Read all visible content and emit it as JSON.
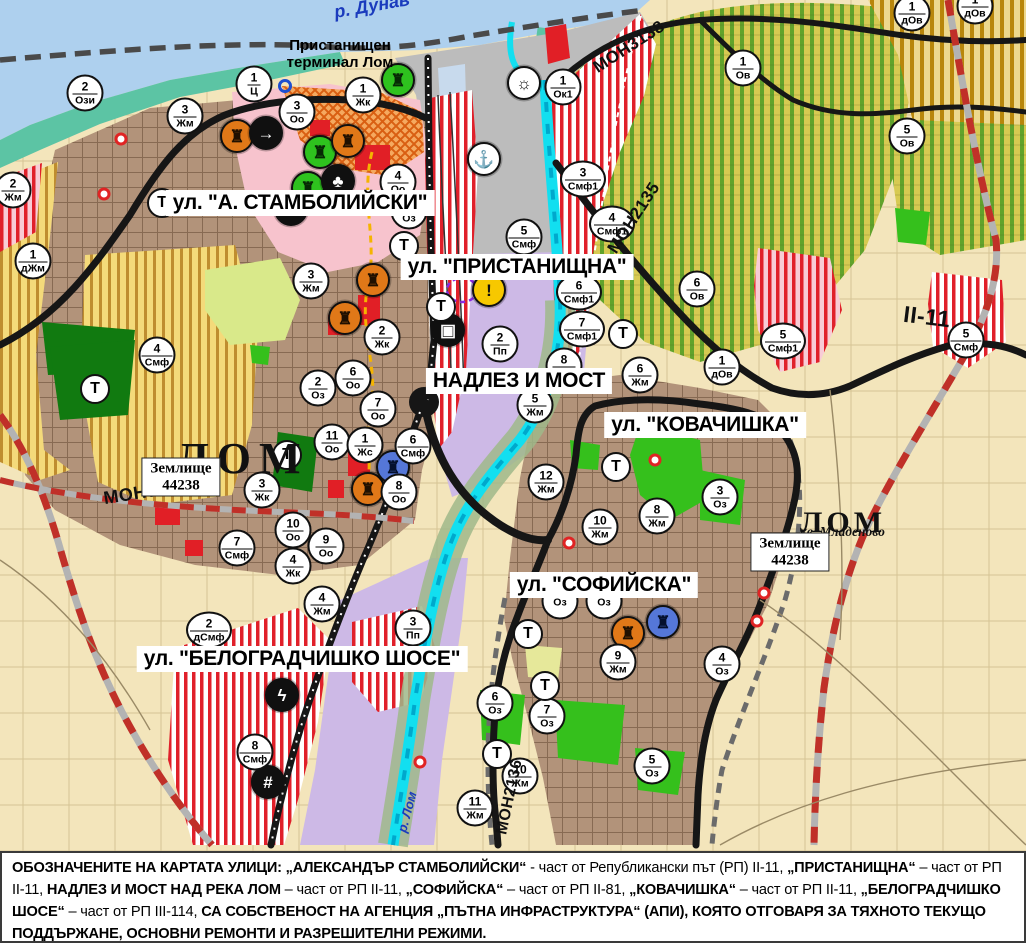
{
  "colors": {
    "field_beige": "#f3e5bb",
    "danube_blue": "#aed0ee",
    "shore_teal": "#5cc4a4",
    "port_gray": "#bcbcbc",
    "urban_brown": "#b2937a",
    "center_pink": "#f7c3cd",
    "industry_lavender": "#cdb9e6",
    "vineyard_green_stripe": "#61a32b",
    "vineyard_bg": "#d7ca52",
    "ochre_stripe": "#b8860b",
    "smf_red_stripe": "#e0202a",
    "park_green": "#35c01c",
    "forest_green": "#117a10",
    "road_black": "#161616",
    "road_red_dash": "#c03028",
    "river_cyan": "#12dff0",
    "label_blue": "#1b3bbd",
    "accent_red": "#e11f26",
    "warning_yellow": "#f7c800",
    "monument_orange": "#e07818",
    "monument_green": "#2ec21e",
    "monument_blue": "#5577d8"
  },
  "map": {
    "street_labels": [
      {
        "text": "ул. \"А. СТАМБОЛИЙСКИ\"",
        "x": 300,
        "y": 203
      },
      {
        "text": "ул. \"ПРИСТАНИЩНА\"",
        "x": 517,
        "y": 267
      },
      {
        "text": "НАДЛЕЗ И МОСТ",
        "x": 519,
        "y": 381
      },
      {
        "text": "ул. \"КОВАЧИШКА\"",
        "x": 705,
        "y": 425
      },
      {
        "text": "ул. \"СОФИЙСКА\"",
        "x": 604,
        "y": 585
      },
      {
        "text": "ул. \"БЕЛОГРАДЧИШКО ШОСЕ\"",
        "x": 302,
        "y": 659
      }
    ],
    "road_labels": [
      {
        "text": "МОН3139",
        "x": 146,
        "y": 492,
        "rot": -9,
        "fs": 18
      },
      {
        "text": "МОН2135",
        "x": 634,
        "y": 218,
        "rot": -57,
        "fs": 17
      },
      {
        "text": "МОН3138",
        "x": 629,
        "y": 47,
        "rot": -33,
        "fs": 17
      },
      {
        "text": "МОН2136",
        "x": 510,
        "y": 797,
        "rot": -78,
        "fs": 16
      },
      {
        "text": "II-11",
        "x": 927,
        "y": 317,
        "rot": 7,
        "fs": 23
      }
    ],
    "place_labels": [
      {
        "cls": "pl-river",
        "text": "р. Дунав",
        "x": 372,
        "y": 6,
        "rot": -10,
        "fs": 18
      },
      {
        "cls": "pl-terminal",
        "text": "Пристанищен\nтерминал Лом",
        "x": 340,
        "y": 54
      },
      {
        "cls": "pl-city",
        "text": "ЛОМ",
        "x": 176,
        "y": 433,
        "fs": 44,
        "ls": 8
      },
      {
        "cls": "pl-parcel",
        "text": "Землище\n44238",
        "x": 181,
        "y": 477
      },
      {
        "cls": "pl-city",
        "text": "ЛОМ",
        "x": 800,
        "y": 506,
        "fs": 30,
        "ls": 4
      },
      {
        "cls": "pl-subcity",
        "text": "кв. Младеново",
        "x": 800,
        "y": 524
      },
      {
        "cls": "pl-parcel",
        "text": "Землище\n44238",
        "x": 790,
        "y": 552
      },
      {
        "cls": "pl-river",
        "text": "р. Лом",
        "x": 407,
        "y": 812,
        "rot": -75,
        "fs": 13
      }
    ],
    "zone_markers": [
      {
        "x": 85,
        "y": 93,
        "num": "2",
        "code": "Ози"
      },
      {
        "x": 254,
        "y": 84,
        "num": "1",
        "code": "Ц"
      },
      {
        "x": 297,
        "y": 112,
        "num": "3",
        "code": "Оо"
      },
      {
        "x": 363,
        "y": 95,
        "num": "1",
        "code": "Жк"
      },
      {
        "x": 563,
        "y": 87,
        "num": "1",
        "code": "Ок1"
      },
      {
        "x": 185,
        "y": 116,
        "num": "3",
        "code": "Жм"
      },
      {
        "x": 13,
        "y": 190,
        "num": "2",
        "code": "Жм"
      },
      {
        "x": 33,
        "y": 261,
        "num": "1",
        "code": "дЖм"
      },
      {
        "x": 398,
        "y": 182,
        "num": "4",
        "code": "Оо"
      },
      {
        "x": 409,
        "y": 211,
        "num": "1",
        "code": "Оз"
      },
      {
        "x": 311,
        "y": 281,
        "num": "3",
        "code": "Жм"
      },
      {
        "x": 524,
        "y": 237,
        "num": "5",
        "code": "Смф"
      },
      {
        "x": 583,
        "y": 179,
        "num": "3",
        "code": "Смф1"
      },
      {
        "x": 612,
        "y": 224,
        "num": "4",
        "code": "Смф1"
      },
      {
        "x": 579,
        "y": 292,
        "num": "6",
        "code": "Смф1"
      },
      {
        "x": 582,
        "y": 329,
        "num": "7",
        "code": "Смф1"
      },
      {
        "x": 500,
        "y": 344,
        "num": "2",
        "code": "Пп"
      },
      {
        "x": 564,
        "y": 366,
        "num": "8",
        "code": "Жм"
      },
      {
        "x": 535,
        "y": 405,
        "num": "5",
        "code": "Жм"
      },
      {
        "x": 640,
        "y": 375,
        "num": "6",
        "code": "Жм"
      },
      {
        "x": 697,
        "y": 289,
        "num": "6",
        "code": "Ов"
      },
      {
        "x": 743,
        "y": 68,
        "num": "1",
        "code": "Ов"
      },
      {
        "x": 912,
        "y": 13,
        "num": "1",
        "code": "дОв"
      },
      {
        "x": 975,
        "y": 6,
        "num": "1",
        "code": "дОв"
      },
      {
        "x": 907,
        "y": 136,
        "num": "5",
        "code": "Ов"
      },
      {
        "x": 783,
        "y": 341,
        "num": "5",
        "code": "Смф1"
      },
      {
        "x": 722,
        "y": 367,
        "num": "1",
        "code": "дОв"
      },
      {
        "x": 966,
        "y": 340,
        "num": "5",
        "code": "Смф"
      },
      {
        "x": 382,
        "y": 337,
        "num": "2",
        "code": "Жк"
      },
      {
        "x": 353,
        "y": 378,
        "num": "6",
        "code": "Оо"
      },
      {
        "x": 318,
        "y": 388,
        "num": "2",
        "code": "Оз"
      },
      {
        "x": 378,
        "y": 409,
        "num": "7",
        "code": "Оо"
      },
      {
        "x": 332,
        "y": 442,
        "num": "11",
        "code": "Оо"
      },
      {
        "x": 365,
        "y": 445,
        "num": "1",
        "code": "Жс"
      },
      {
        "x": 413,
        "y": 446,
        "num": "6",
        "code": "Смф"
      },
      {
        "x": 399,
        "y": 492,
        "num": "8",
        "code": "Оо"
      },
      {
        "x": 293,
        "y": 530,
        "num": "10",
        "code": "Оо"
      },
      {
        "x": 326,
        "y": 546,
        "num": "9",
        "code": "Оо"
      },
      {
        "x": 293,
        "y": 566,
        "num": "4",
        "code": "Жк"
      },
      {
        "x": 237,
        "y": 548,
        "num": "7",
        "code": "Смф"
      },
      {
        "x": 262,
        "y": 490,
        "num": "3",
        "code": "Жк"
      },
      {
        "x": 157,
        "y": 355,
        "num": "4",
        "code": "Смф"
      },
      {
        "x": 546,
        "y": 482,
        "num": "12",
        "code": "Жм"
      },
      {
        "x": 600,
        "y": 527,
        "num": "10",
        "code": "Жм"
      },
      {
        "x": 657,
        "y": 516,
        "num": "8",
        "code": "Жм"
      },
      {
        "x": 720,
        "y": 497,
        "num": "3",
        "code": "Оз"
      },
      {
        "x": 209,
        "y": 630,
        "num": "2",
        "code": "дСмф"
      },
      {
        "x": 322,
        "y": 604,
        "num": "4",
        "code": "Жм"
      },
      {
        "x": 413,
        "y": 628,
        "num": "3",
        "code": "Пп"
      },
      {
        "x": 255,
        "y": 752,
        "num": "8",
        "code": "Смф"
      },
      {
        "x": 495,
        "y": 703,
        "num": "6",
        "code": "Оз"
      },
      {
        "x": 547,
        "y": 716,
        "num": "7",
        "code": "Оз"
      },
      {
        "x": 618,
        "y": 662,
        "num": "9",
        "code": "Жм"
      },
      {
        "x": 722,
        "y": 664,
        "num": "4",
        "code": "Оз"
      },
      {
        "x": 652,
        "y": 766,
        "num": "5",
        "code": "Оз"
      },
      {
        "x": 520,
        "y": 776,
        "num": "10",
        "code": "Жм"
      },
      {
        "x": 475,
        "y": 808,
        "num": "11",
        "code": "Жм"
      },
      {
        "x": 560,
        "y": 601,
        "num": "",
        "code": "Оз"
      },
      {
        "x": 604,
        "y": 601,
        "num": "",
        "code": "Оз"
      }
    ],
    "t_markers": [
      {
        "x": 162,
        "y": 203
      },
      {
        "x": 404,
        "y": 246
      },
      {
        "x": 441,
        "y": 307
      },
      {
        "x": 623,
        "y": 334
      },
      {
        "x": 287,
        "y": 455
      },
      {
        "x": 95,
        "y": 389
      },
      {
        "x": 616,
        "y": 467
      },
      {
        "x": 545,
        "y": 686
      },
      {
        "x": 497,
        "y": 754
      },
      {
        "x": 528,
        "y": 634
      }
    ],
    "t_label": "Т",
    "landmark_icons": [
      {
        "x": 237,
        "y": 136,
        "type": "monument-icon",
        "glyph": "♜",
        "bg": "#e07818",
        "fg": "#201000"
      },
      {
        "x": 266,
        "y": 133,
        "type": "arrow-icon",
        "glyph": "→",
        "bg": "#101010",
        "fg": "#ffffff"
      },
      {
        "x": 320,
        "y": 152,
        "type": "monument-icon",
        "glyph": "♜",
        "bg": "#2ec21e",
        "fg": "#072a05"
      },
      {
        "x": 348,
        "y": 141,
        "type": "monument-icon",
        "glyph": "♜",
        "bg": "#e07818",
        "fg": "#201000"
      },
      {
        "x": 308,
        "y": 188,
        "type": "monument-icon",
        "glyph": "♜",
        "bg": "#2ec21e",
        "fg": "#072a05"
      },
      {
        "x": 338,
        "y": 181,
        "type": "club-icon",
        "glyph": "♣",
        "bg": "#101010",
        "fg": "#ffffff"
      },
      {
        "x": 291,
        "y": 209,
        "type": "mountain-icon",
        "glyph": "▲",
        "bg": "#101010",
        "fg": "#ffffff"
      },
      {
        "x": 398,
        "y": 80,
        "type": "monument-icon",
        "glyph": "♜",
        "bg": "#2ec21e",
        "fg": "#072a05"
      },
      {
        "x": 373,
        "y": 280,
        "type": "monument-icon",
        "glyph": "♜",
        "bg": "#e07818",
        "fg": "#201000"
      },
      {
        "x": 345,
        "y": 318,
        "type": "monument-icon",
        "glyph": "♜",
        "bg": "#e07818",
        "fg": "#201000"
      },
      {
        "x": 368,
        "y": 489,
        "type": "monument-icon",
        "glyph": "♜",
        "bg": "#e07818",
        "fg": "#201000"
      },
      {
        "x": 393,
        "y": 467,
        "type": "monument-icon",
        "glyph": "♜",
        "bg": "#5577d8",
        "fg": "#04102e"
      },
      {
        "x": 628,
        "y": 633,
        "type": "monument-icon",
        "glyph": "♜",
        "bg": "#e07818",
        "fg": "#201000"
      },
      {
        "x": 663,
        "y": 622,
        "type": "monument-icon",
        "glyph": "♜",
        "bg": "#5577d8",
        "fg": "#04102e"
      },
      {
        "x": 484,
        "y": 159,
        "type": "anchor-icon",
        "glyph": "⚓",
        "bg": "#ffffff",
        "fg": "#101010"
      },
      {
        "x": 524,
        "y": 83,
        "type": "sun-icon",
        "glyph": "☼",
        "bg": "#ffffff",
        "fg": "#101010"
      },
      {
        "x": 448,
        "y": 330,
        "type": "truck-icon",
        "glyph": "▣",
        "bg": "#101010",
        "fg": "#ffffff"
      },
      {
        "x": 489,
        "y": 290,
        "type": "warning-icon",
        "glyph": "!",
        "bg": "#f7c800",
        "fg": "#101010"
      },
      {
        "x": 282,
        "y": 695,
        "type": "lightning-icon",
        "glyph": "ϟ",
        "bg": "#101010",
        "fg": "#ffffff"
      },
      {
        "x": 268,
        "y": 782,
        "type": "rail-crossing-icon",
        "glyph": "#",
        "bg": "#101010",
        "fg": "#ffffff"
      }
    ],
    "red_dots": [
      [
        121,
        139
      ],
      [
        104,
        194
      ],
      [
        655,
        460
      ],
      [
        569,
        543
      ],
      [
        420,
        762
      ],
      [
        764,
        593
      ],
      [
        757,
        621
      ]
    ],
    "blue_ring": {
      "x": 285,
      "y": 86
    }
  },
  "footer": {
    "segments": [
      {
        "t": "ОБОЗНАЧЕНИТЕ НА КАРТАТА УЛИЦИ: ",
        "b": 1
      },
      {
        "t": "„АЛЕКСАНДЪР СТАМБОЛИЙСКИ“",
        "b": 1
      },
      {
        "t": " - част от Републикански път (РП) II-11, ",
        "b": 0
      },
      {
        "t": "„ПРИСТАНИЩНА“",
        "b": 1
      },
      {
        "t": " – част от РП II-11, ",
        "b": 0
      },
      {
        "t": "НАДЛЕЗ И МОСТ НАД РЕКА ЛОМ",
        "b": 1
      },
      {
        "t": " – част от РП II-11, ",
        "b": 0
      },
      {
        "t": "„СОФИЙСКА“",
        "b": 1
      },
      {
        "t": " – част от РП II-81, ",
        "b": 0
      },
      {
        "t": "„КОВАЧИШКА“",
        "b": 1
      },
      {
        "t": " – част от РП II-11, ",
        "b": 0
      },
      {
        "t": "„БЕЛОГРАДЧИШКО ШОСЕ“",
        "b": 1
      },
      {
        "t": " – част от РП III-114, ",
        "b": 0
      },
      {
        "t": "СА СОБСТВЕНОСТ НА АГЕНЦИЯ „ПЪТНА ИНФРАСТРУКТУРА“ (АПИ), КОЯТО ОТГОВАРЯ ЗА ТЯХНОТО ТЕКУЩО ПОДДЪРЖАНЕ, ОСНОВНИ РЕМОНТИ И РАЗРЕШИТЕЛНИ РЕЖИМИ.",
        "b": 1
      }
    ]
  }
}
